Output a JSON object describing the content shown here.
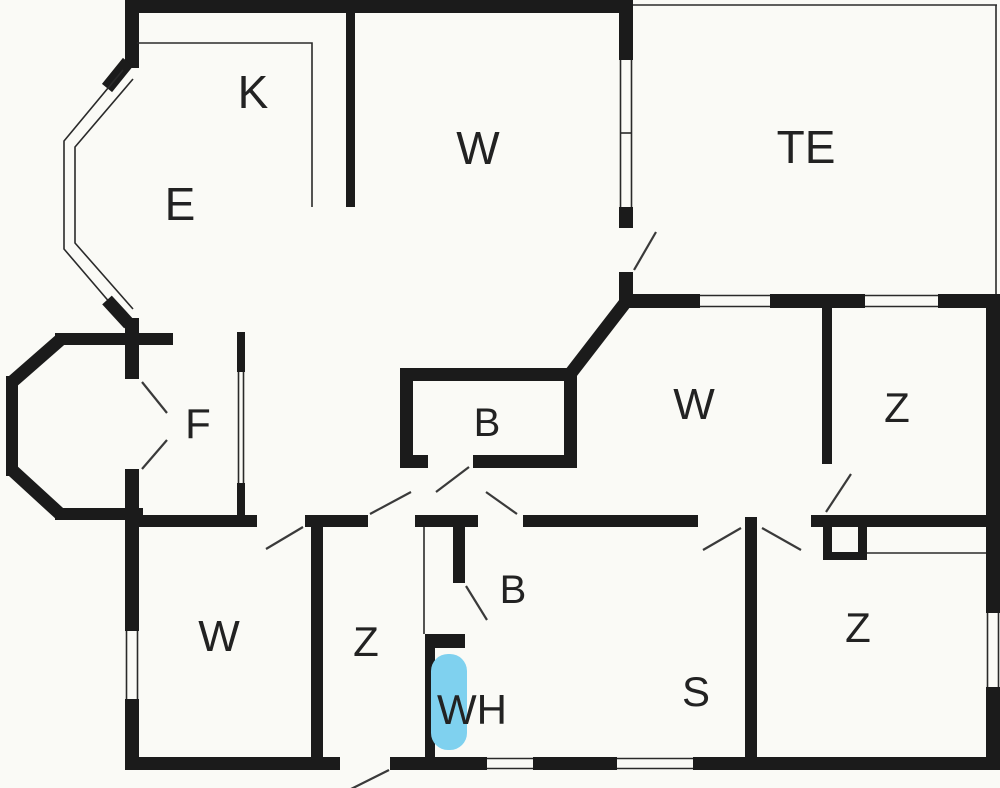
{
  "plan": {
    "type": "apartment-floor-plan",
    "rooms": [
      {
        "id": "kitchen",
        "label": "K"
      },
      {
        "id": "dining",
        "label": "E"
      },
      {
        "id": "living-room",
        "label": "W"
      },
      {
        "id": "terrace",
        "label": "TE"
      },
      {
        "id": "hall",
        "label": "F"
      },
      {
        "id": "bathroom-upper",
        "label": "B"
      },
      {
        "id": "bedroom-right",
        "label": "W"
      },
      {
        "id": "bedroom-top-right",
        "label": "Z"
      },
      {
        "id": "bedroom-bottom-left",
        "label": "W"
      },
      {
        "id": "room-bottom-left",
        "label": "Z"
      },
      {
        "id": "bathroom-lower",
        "label": "B"
      },
      {
        "id": "water-heater-room",
        "label": "WH"
      },
      {
        "id": "sauna",
        "label": "S"
      },
      {
        "id": "bedroom-bottom-right",
        "label": "Z"
      }
    ],
    "features": [
      {
        "id": "water-heater",
        "label": ""
      }
    ]
  },
  "colors": {
    "wall": "#1b1b1b",
    "background": "#fafaf6",
    "label": "#222222",
    "water_heater": "#7fd1ef"
  }
}
